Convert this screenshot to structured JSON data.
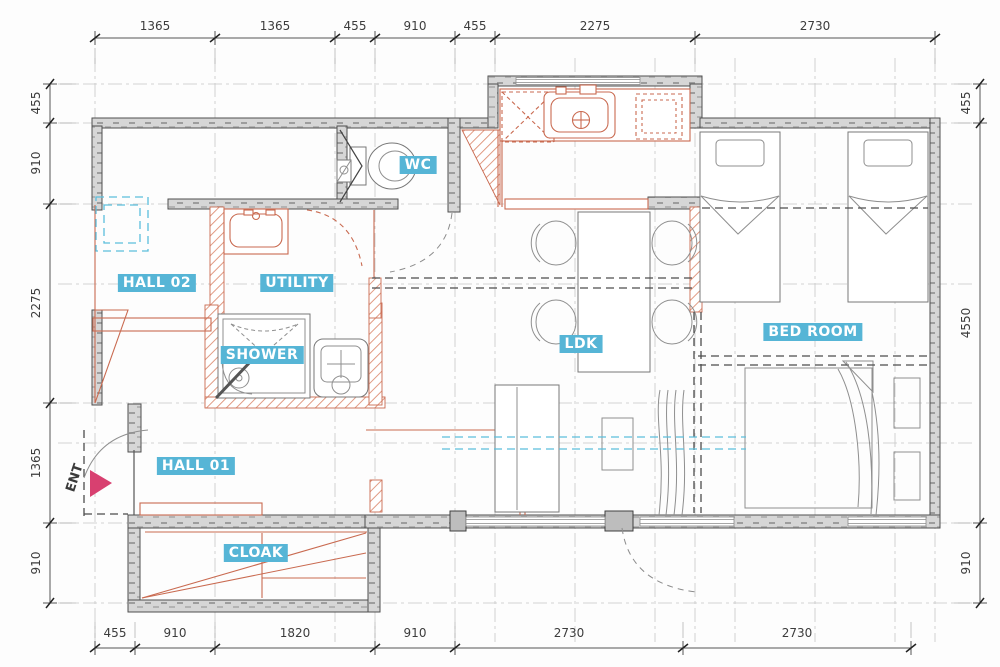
{
  "plan": {
    "type": "apartment-floor-plan",
    "rooms": [
      {
        "name": "WC"
      },
      {
        "name": "HALL 02"
      },
      {
        "name": "UTILITY"
      },
      {
        "name": "SHOWER"
      },
      {
        "name": "HALL 01"
      },
      {
        "name": "CLOAK"
      },
      {
        "name": "LDK"
      },
      {
        "name": "BED ROOM"
      }
    ],
    "entrance_label": "ENT",
    "dimensions_mm": {
      "top": [
        "1365",
        "1365",
        "455",
        "910",
        "455",
        "2275",
        "2730"
      ],
      "bottom": [
        "455",
        "910",
        "1820",
        "910",
        "2730",
        "2730"
      ],
      "left": [
        "455",
        "910",
        "2275",
        "1365",
        "910"
      ],
      "right": [
        "455",
        "4550",
        "910"
      ]
    },
    "colors": {
      "label_bg": "#56b5d6",
      "label_text": "#ffffff",
      "wall_gray": "#d2d2d2",
      "fixture_orange": "#c96a50",
      "entrance_arrow": "#d84070",
      "aqua_dashed": "#5bbedc"
    }
  }
}
